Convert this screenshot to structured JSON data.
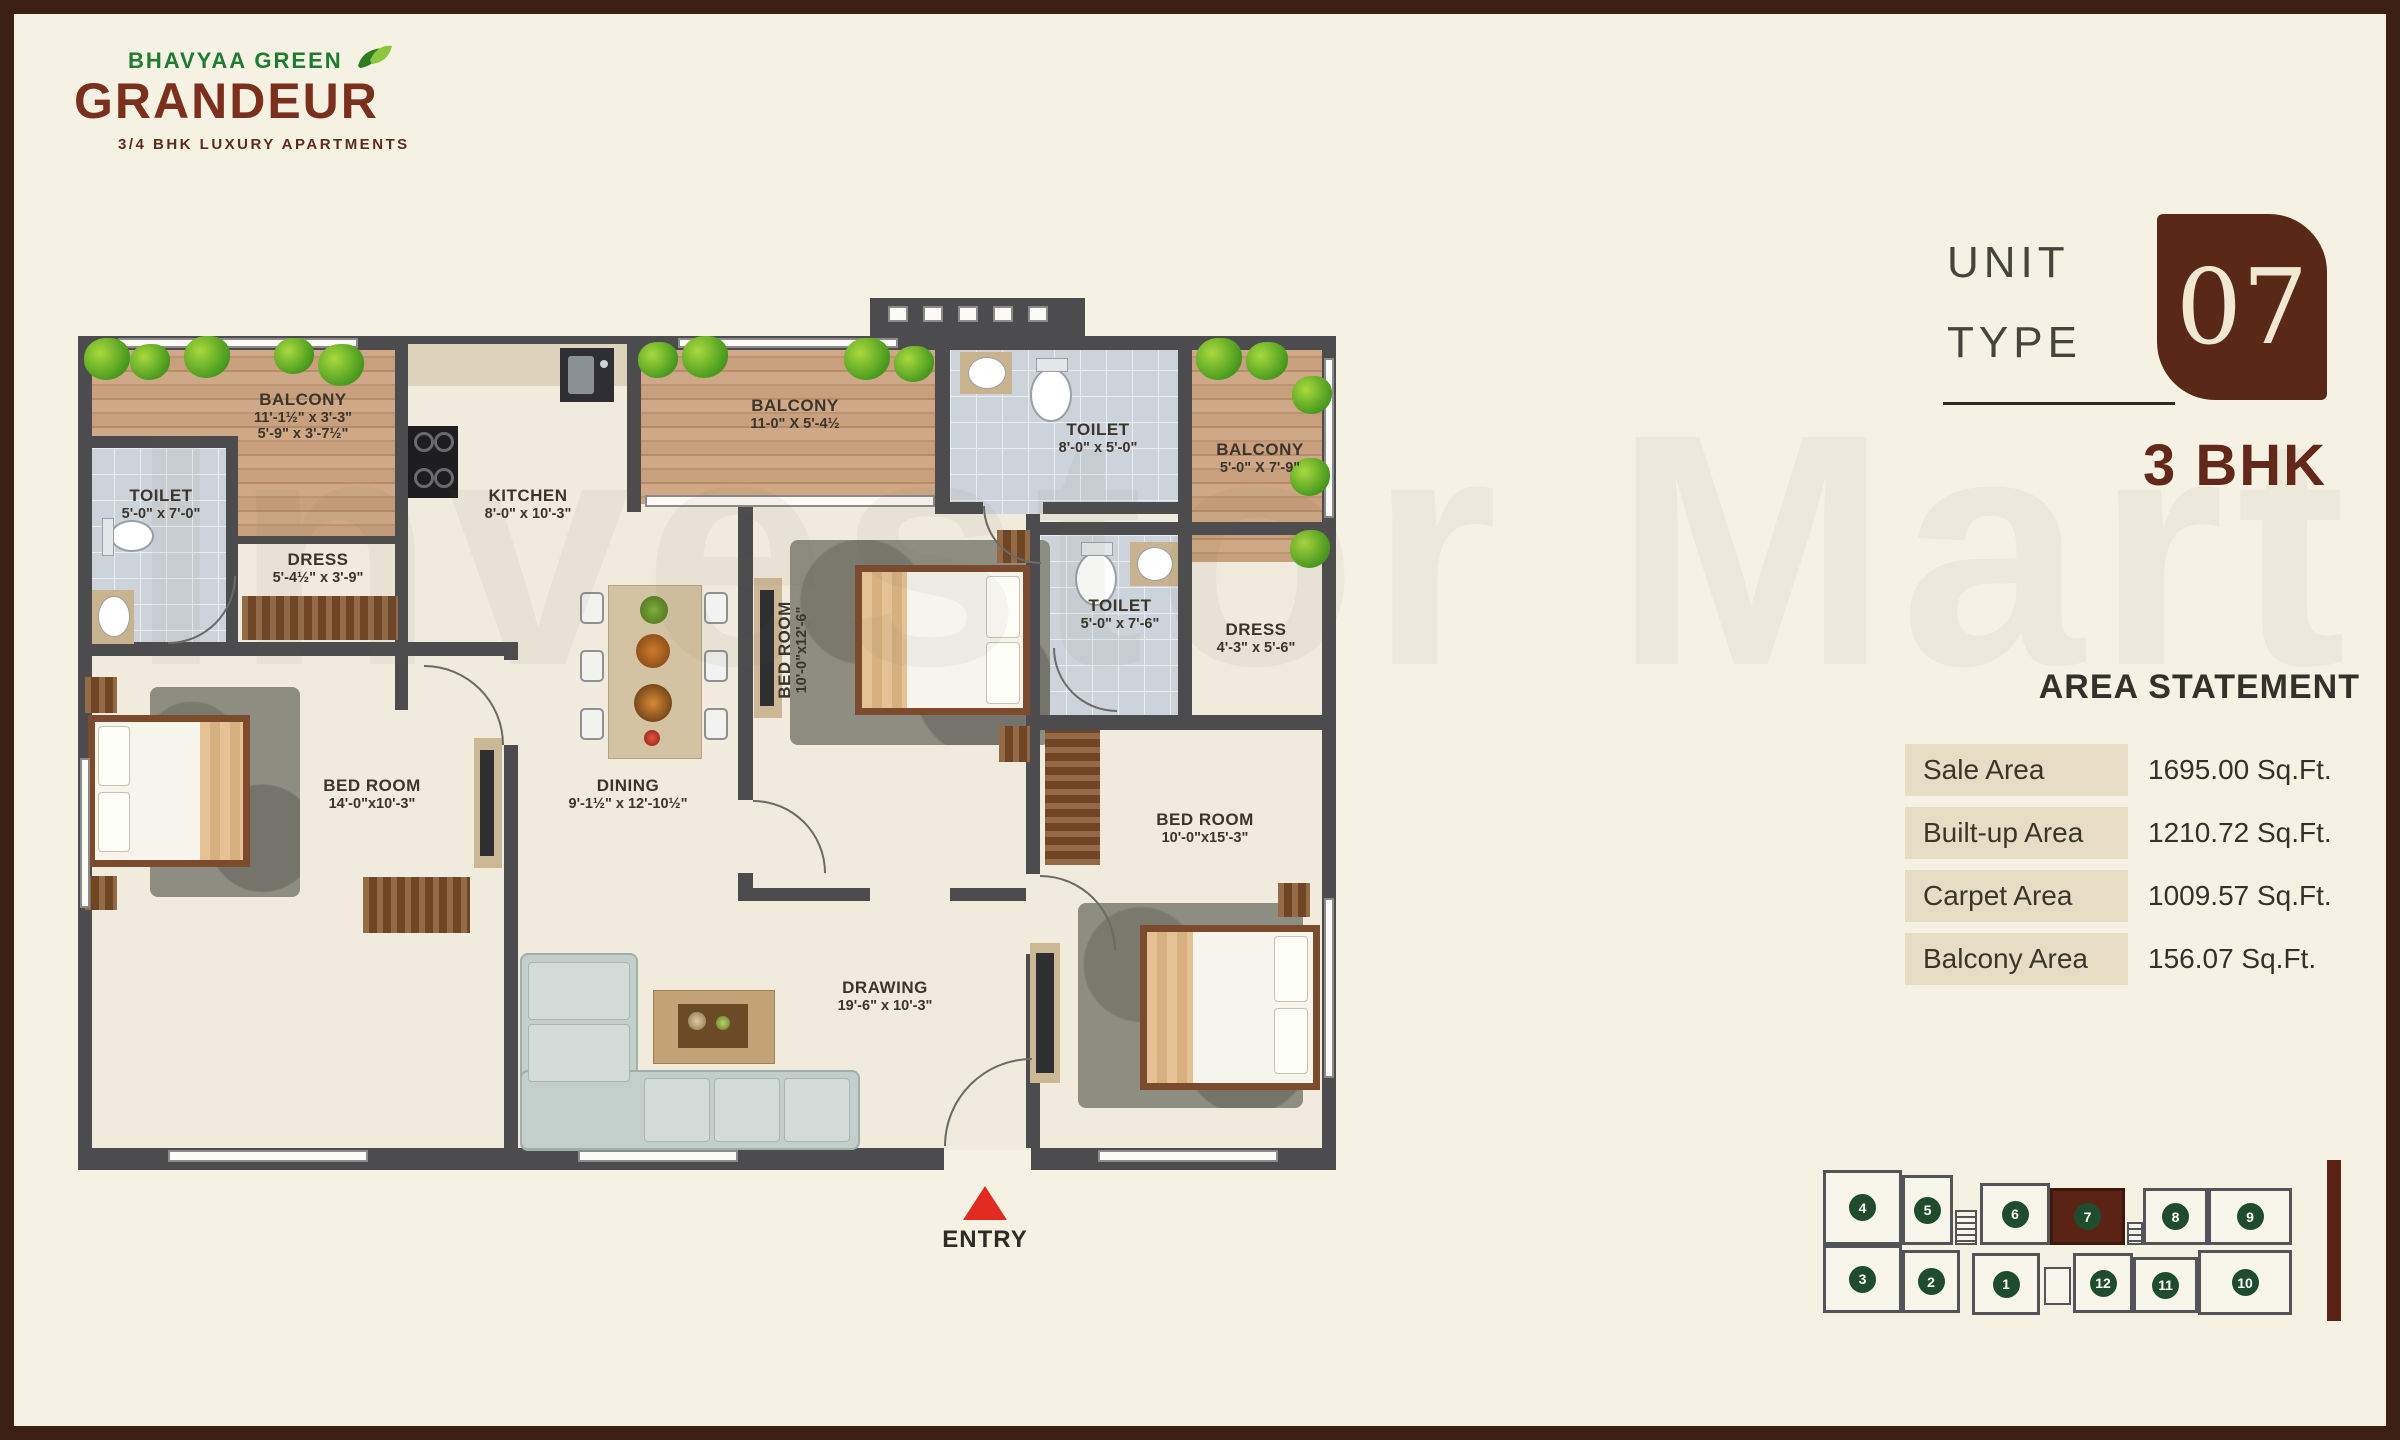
{
  "page": {
    "bg": "#f5f2e4",
    "frame_color": "#3c2013"
  },
  "logo": {
    "brand": "BHAVYAA GREEN",
    "name": "GRANDEUR",
    "tagline": "3/4 BHK LUXURY APARTMENTS",
    "green": "#1e7b31",
    "brown": "#7b2f1d"
  },
  "unit": {
    "word1": "UNIT",
    "word2": "TYPE",
    "number": "07",
    "bhk": "3 BHK",
    "badge_bg": "#5a2817"
  },
  "area": {
    "title": "AREA STATEMENT",
    "rows": [
      {
        "label": "Sale Area",
        "value": "1695.00 Sq.Ft."
      },
      {
        "label": "Built-up Area",
        "value": "1210.72 Sq.Ft."
      },
      {
        "label": "Carpet Area",
        "value": "1009.57 Sq.Ft."
      },
      {
        "label": "Balcony Area",
        "value": "156.07 Sq.Ft."
      }
    ]
  },
  "rooms": {
    "balcony1": {
      "name": "BALCONY",
      "dim1": "11'-1½\" x 3'-3\"",
      "dim2": "5'-9\" x 3'-7½\""
    },
    "toilet1": {
      "name": "TOILET",
      "dim1": "5'-0\" x 7'-0\""
    },
    "dress1": {
      "name": "DRESS",
      "dim1": "5'-4½\" x 3'-9\""
    },
    "kitchen": {
      "name": "KITCHEN",
      "dim1": "8'-0\" x 10'-3\""
    },
    "balcony2": {
      "name": "BALCONY",
      "dim1": "11-0\" X 5'-4½"
    },
    "toilet2": {
      "name": "TOILET",
      "dim1": "8'-0\" x 5'-0\""
    },
    "balcony3": {
      "name": "BALCONY",
      "dim1": "5'-0\" X 7'-9\""
    },
    "toilet3": {
      "name": "TOILET",
      "dim1": "5'-0\" x 7'-6\""
    },
    "dress2": {
      "name": "DRESS",
      "dim1": "4'-3\" x 5'-6\""
    },
    "bedroom_mid": {
      "name": "BED ROOM",
      "dim1": "10'-0\"x12'-6\""
    },
    "bedroom_left": {
      "name": "BED ROOM",
      "dim1": "14'-0\"x10'-3\""
    },
    "bedroom_right": {
      "name": "BED ROOM",
      "dim1": "10'-0\"x15'-3\""
    },
    "dining": {
      "name": "DINING",
      "dim1": "9'-1½\" x 12'-10½\""
    },
    "drawing": {
      "name": "DRAWING",
      "dim1": "19'-6\" x 10'-3\""
    }
  },
  "entry": {
    "label": "ENTRY",
    "arrow_color": "#e22b20"
  },
  "keyplan": {
    "top": [
      "4",
      "5",
      "6",
      "7",
      "8",
      "9"
    ],
    "bottom": [
      "3",
      "2",
      "1",
      "12",
      "11",
      "10"
    ],
    "highlighted_unit": "7",
    "circle_color": "#1e4c2c",
    "highlight_color": "#5a2315"
  },
  "watermark": "Investor Mart"
}
